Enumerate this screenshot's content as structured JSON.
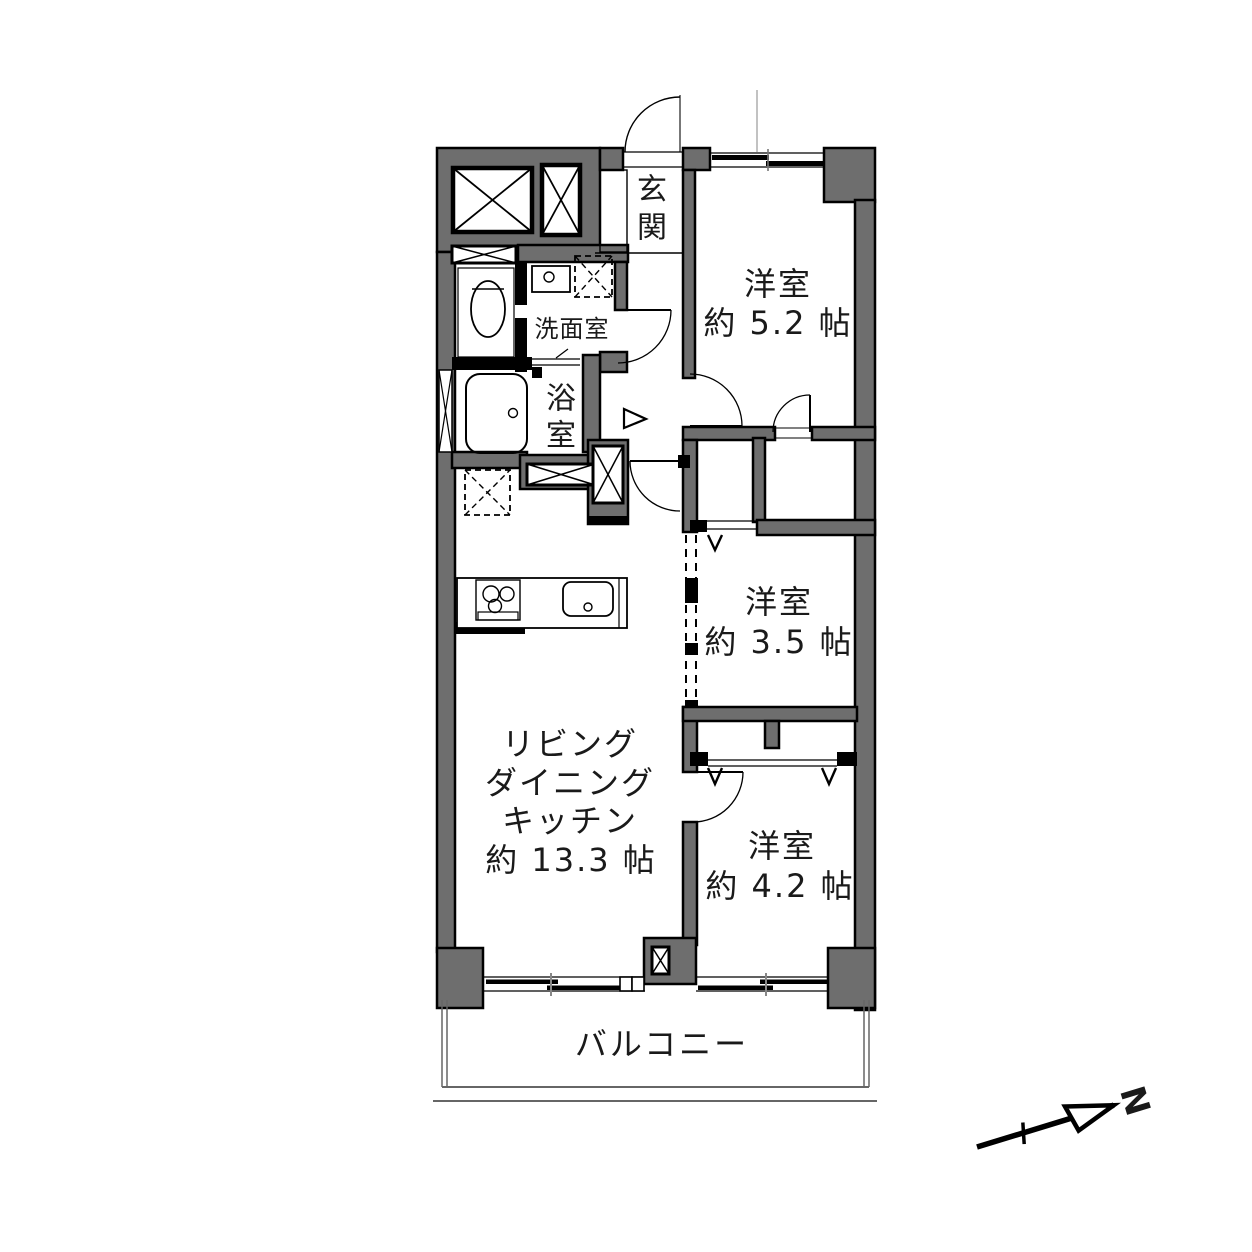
{
  "meta": {
    "bg_color": "#ffffff",
    "wall_color": "#6e6e6e",
    "line_color": "#000000"
  },
  "rooms": {
    "entrance": {
      "name_chars": [
        "玄",
        "関"
      ]
    },
    "bedroom1": {
      "name": "洋室",
      "size": "約 5.2 帖"
    },
    "bedroom2": {
      "name": "洋室",
      "size": "約 3.5 帖"
    },
    "bedroom3": {
      "name": "洋室",
      "size": "約 4.2 帖"
    },
    "ldk": {
      "name_lines": [
        "リビング",
        "ダイニング",
        "キッチン"
      ],
      "size": "約 13.3 帖"
    },
    "washroom": {
      "name": "洗面室"
    },
    "bathroom": {
      "name_chars": [
        "浴",
        "室"
      ]
    },
    "balcony": {
      "name": "バルコニー"
    }
  },
  "compass": {
    "north_label": "N"
  }
}
